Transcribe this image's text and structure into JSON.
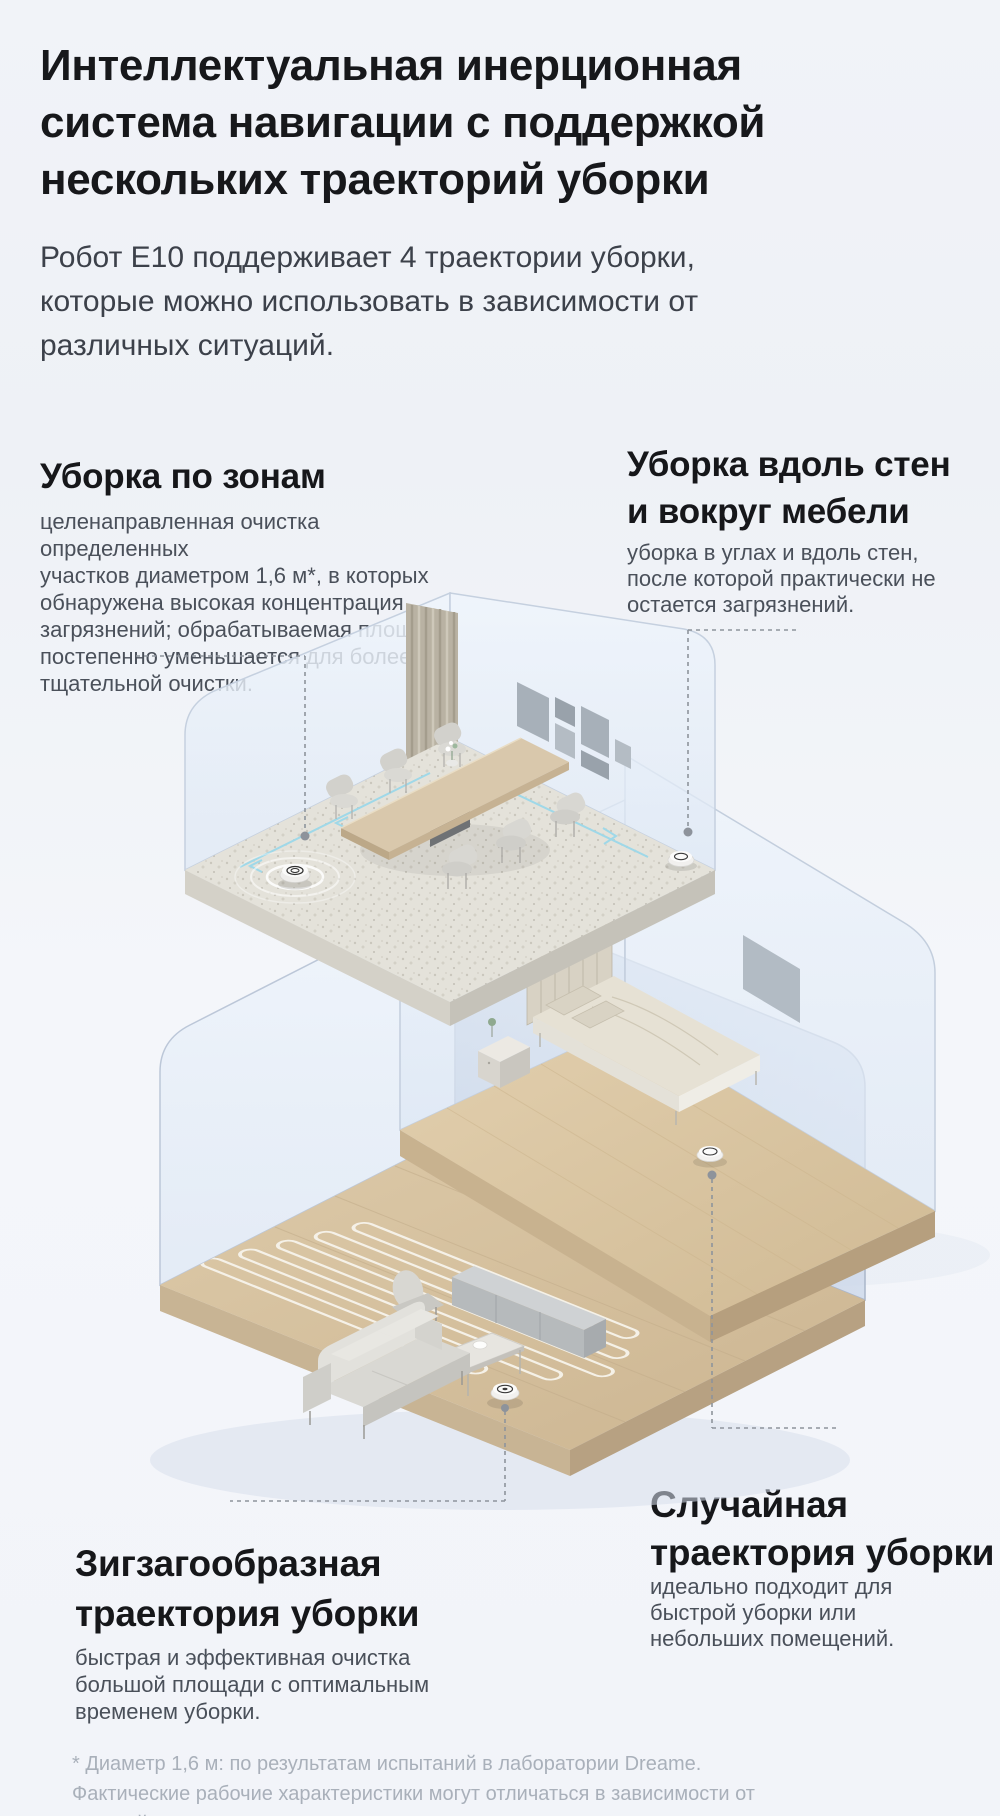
{
  "page": {
    "background_color": "#f1f3f8",
    "accent_text_color": "#17181b",
    "body_text_color": "#4a505a",
    "footnote_color": "#a9b0ba",
    "leader_line_color": "#8e949c",
    "path_arrow_color": "#9fd8e8"
  },
  "header": {
    "title": "Интеллектуальная инерционная\nсистема навигации с поддержкой\nнескольких траекторий уборки",
    "intro": "Робот E10 поддерживает 4 траектории уборки,\nкоторые можно использовать в зависимости от\nразличных ситуаций."
  },
  "features": {
    "zone": {
      "title": "Уборка по зонам",
      "description": "целенаправленная очистка определенных\nучастков диаметром 1,6 м*, в которых\nобнаружена высокая концентрация\nзагрязнений; обрабатываемая площадь\nпостепенно уменьшается для более\nтщательной очистки."
    },
    "edge": {
      "title": "Уборка вдоль стен\nи вокруг мебели",
      "description": "уборка в углах и вдоль стен,\nпосле которой практически не\nостается загрязнений."
    },
    "zigzag": {
      "title": "Зигзагообразная\nтраектория уборки",
      "description": "быстрая и эффективная очистка\nбольшой площади с оптимальным\nвременем уборки."
    },
    "random": {
      "title": "Случайная\nтраектория уборки",
      "description": "идеально подходит для\nбыстрой уборки или\nнебольших помещений."
    }
  },
  "footnote": "* Диаметр 1,6 м: по результатам испытаний в лаборатории Dreame.\nФактические рабочие характеристики могут отличаться в зависимости от\nусловий использования.",
  "illustration": {
    "rooms": [
      "dining-room",
      "bedroom",
      "living-room"
    ],
    "robots": [
      "zone-cleaning-robot",
      "edge-cleaning-robot",
      "random-path-robot",
      "zigzag-path-robot"
    ]
  }
}
